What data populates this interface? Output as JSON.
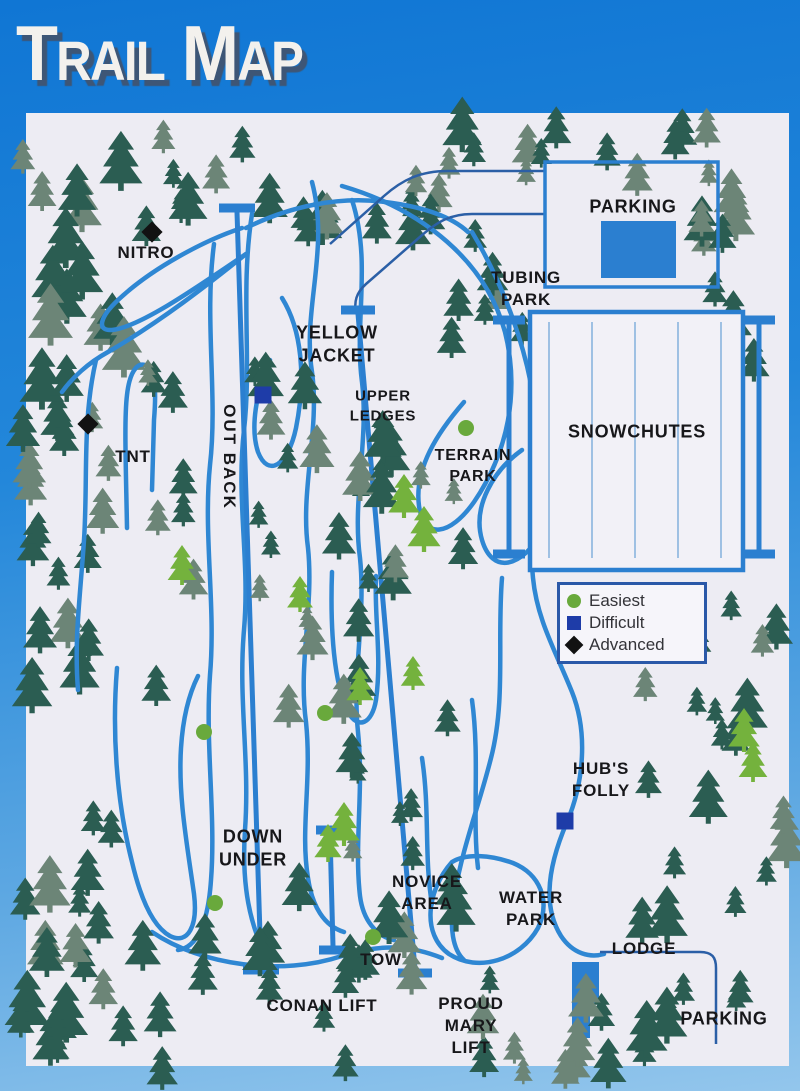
{
  "title": {
    "text": "Trail Map",
    "display": {
      "word1": {
        "initial": "T",
        "rest": "RAIL"
      },
      "word2": {
        "initial": "M",
        "rest": "AP"
      }
    }
  },
  "trail_labels": {
    "nitro": "NITRO",
    "tnt": "TNT",
    "yellow_jacket": [
      "YELLOW",
      "JACKET"
    ],
    "out_back": "OUT BACK",
    "upper_ledges": [
      "UPPER",
      "LEDGES"
    ],
    "terrain_park": [
      "TERRAIN",
      "PARK"
    ],
    "down_under": [
      "DOWN",
      "UNDER"
    ],
    "hubs_folly": [
      "HUB'S",
      "FOLLY"
    ],
    "novice_area": [
      "NOVICE",
      "AREA"
    ]
  },
  "facility_labels": {
    "parking_top": "PARKING",
    "parking_bottom": "PARKING",
    "tubing_park": [
      "TUBING",
      "PARK"
    ],
    "snowchutes": "SNOWCHUTES",
    "water_park": [
      "WATER",
      "PARK"
    ],
    "lodge": "LODGE"
  },
  "lift_labels": {
    "tow": "TOW",
    "conan_lift": "CONAN LIFT",
    "proud_mary_lift": [
      "PROUD",
      "MARY",
      "LIFT"
    ]
  },
  "legend": {
    "items": [
      {
        "label": "Easiest",
        "symbol": "circle",
        "color": "#69a93c"
      },
      {
        "label": "Difficult",
        "symbol": "square",
        "color": "#1e3ca8"
      },
      {
        "label": "Advanced",
        "symbol": "diamond",
        "color": "#121212"
      }
    ]
  },
  "difficulty_markers": [
    {
      "near_label": "NITRO",
      "difficulty": "advanced"
    },
    {
      "near_label": "TNT",
      "difficulty": "advanced"
    },
    {
      "near_label": "YELLOW JACKET",
      "difficulty": "difficult"
    },
    {
      "near_label": "HUB'S FOLLY",
      "difficulty": "difficult"
    },
    {
      "near_label": "TERRAIN PARK",
      "difficulty": "easiest"
    },
    {
      "near_label": "OUT BACK",
      "difficulty": "easiest"
    },
    {
      "near_label": "DOWN UNDER",
      "difficulty": "easiest"
    },
    {
      "near_label": "DOWN UNDER",
      "difficulty": "easiest"
    },
    {
      "near_label": "TOW",
      "difficulty": "easiest"
    }
  ],
  "colors": {
    "frame_top": "#1076d4",
    "frame_bottom": "#93c6ec",
    "panel": "#edecf3",
    "trail": "#2f87d3",
    "road": "#2b5fa6",
    "structure": "#2b7fd0",
    "chute_lane": "#8ab5de",
    "tree_dark": "#2b5d52",
    "tree_gray": "#6c8577",
    "tree_light": "#74b23d",
    "label_text": "#17171a",
    "easiest": "#69a93c",
    "difficult": "#1e3ca8",
    "advanced": "#121212"
  }
}
